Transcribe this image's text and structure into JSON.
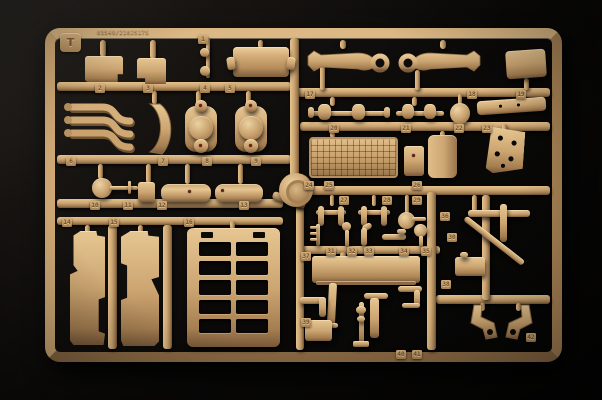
{
  "scene": {
    "background_color": "#0a0908",
    "plastic_color": "#cda672",
    "plastic_highlight": "#e6c692",
    "plastic_shadow": "#6f5434",
    "paint_mark_color": "#6e1d16"
  },
  "sprue": {
    "letter": "T",
    "mold_code": "03549/210J517S",
    "part_tags": [
      "1",
      "2",
      "3",
      "4",
      "5",
      "6",
      "7",
      "8",
      "9",
      "10",
      "11",
      "12",
      "13",
      "14",
      "15",
      "16",
      "17",
      "18",
      "19",
      "20",
      "21",
      "22",
      "23",
      "24",
      "25",
      "26",
      "27",
      "28",
      "29",
      "30",
      "31",
      "32",
      "33",
      "34",
      "35",
      "36",
      "37",
      "38",
      "39",
      "40",
      "41",
      "42"
    ]
  }
}
